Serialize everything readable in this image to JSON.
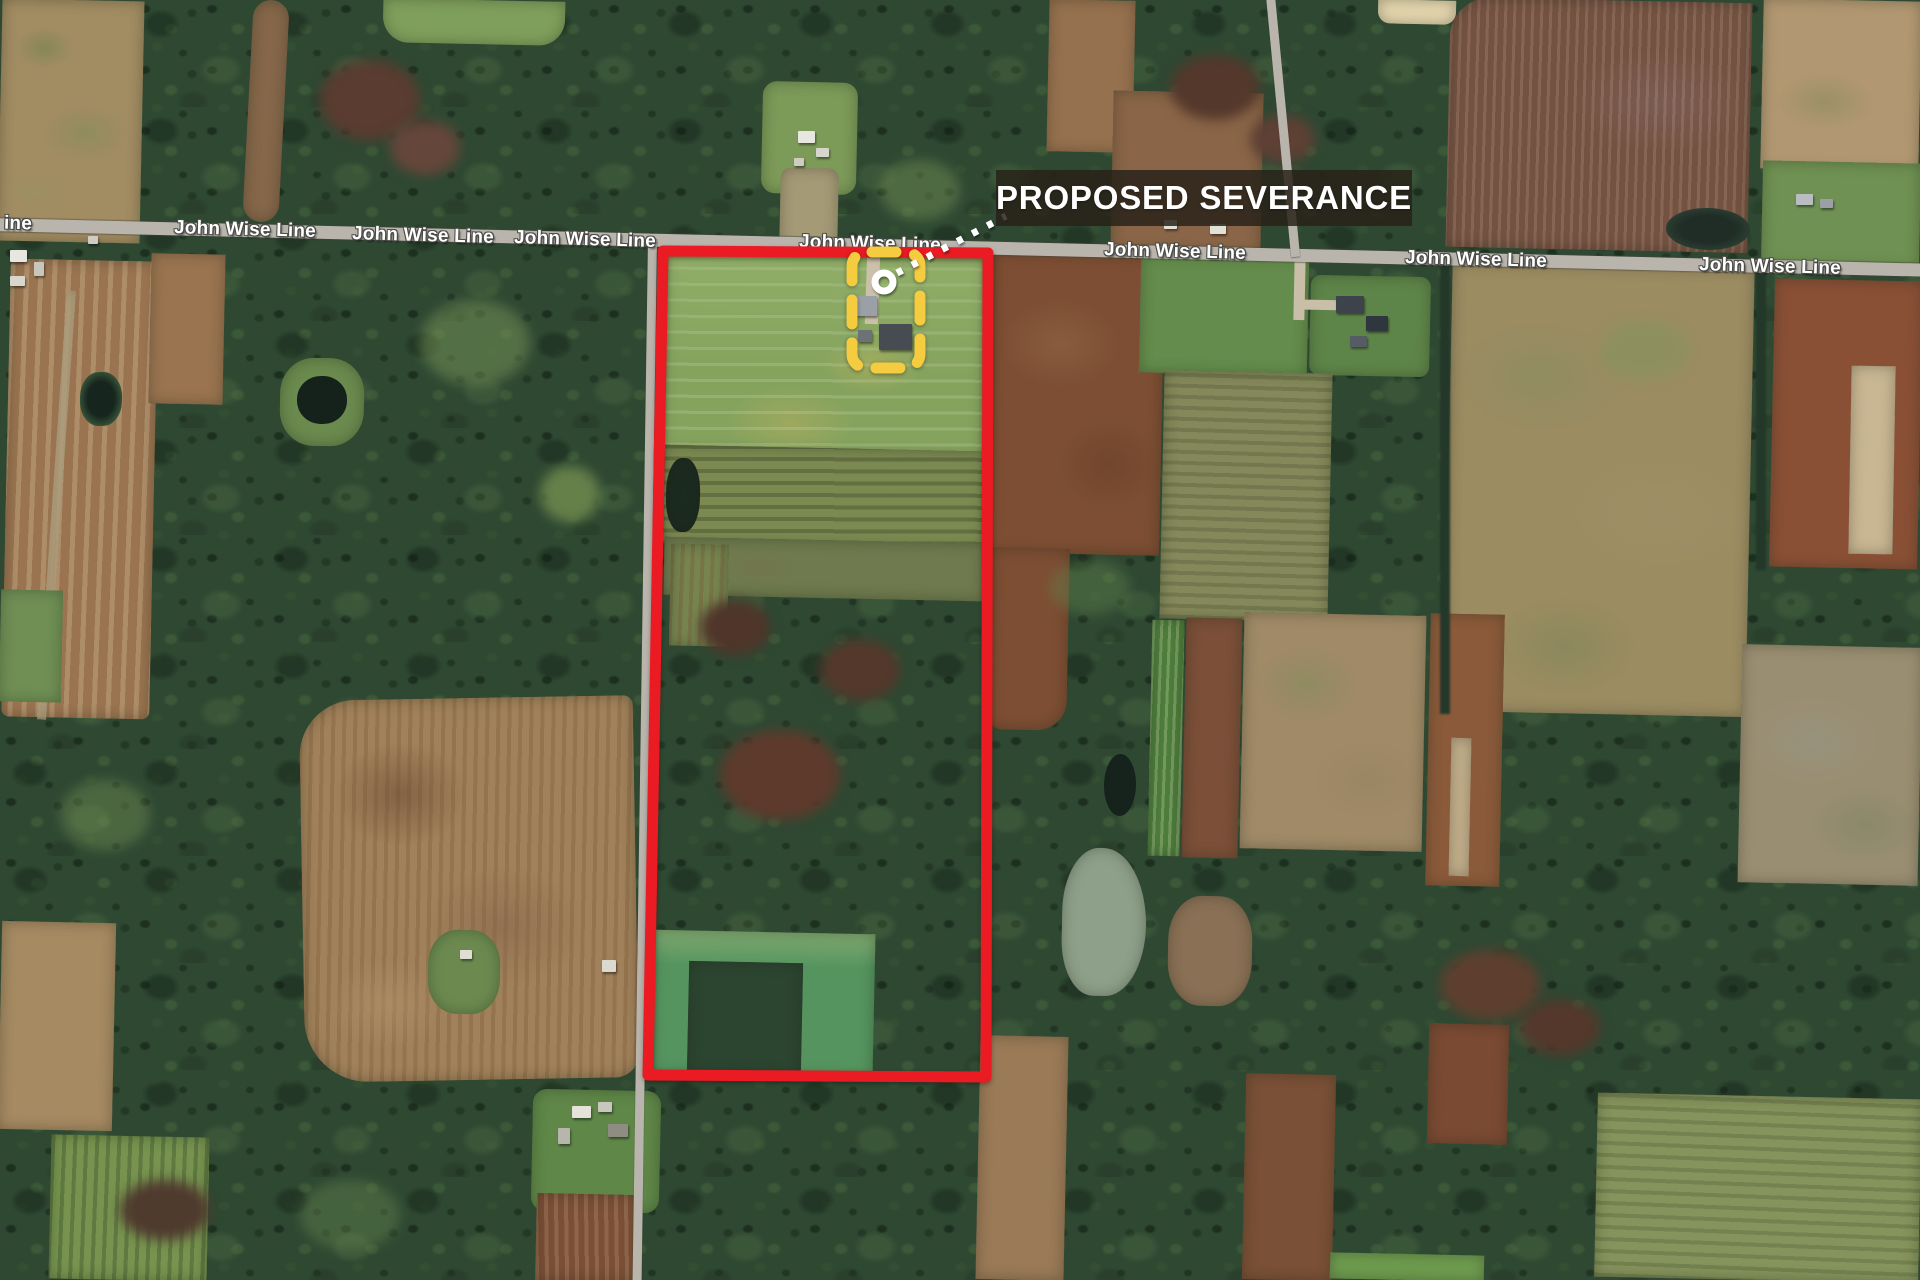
{
  "map": {
    "annotation": {
      "label": "PROPOSED SEVERANCE"
    },
    "road": {
      "name": "John Wise Line",
      "labels": [
        "ine",
        "John Wise Line",
        "John Wise Line",
        "John Wise Line",
        "John Wise Line",
        "John Wise Line",
        "John Wise Line",
        "John Wise Line"
      ]
    },
    "colors": {
      "boundary_red": "#EA1B23",
      "marker_yellow": "#F5CC3F",
      "leader_white": "#FFFFFF",
      "label_bg": "rgba(40,34,25,0.85)",
      "label_text": "#FFFFFF",
      "road_fill": "#B9B5AD"
    }
  }
}
